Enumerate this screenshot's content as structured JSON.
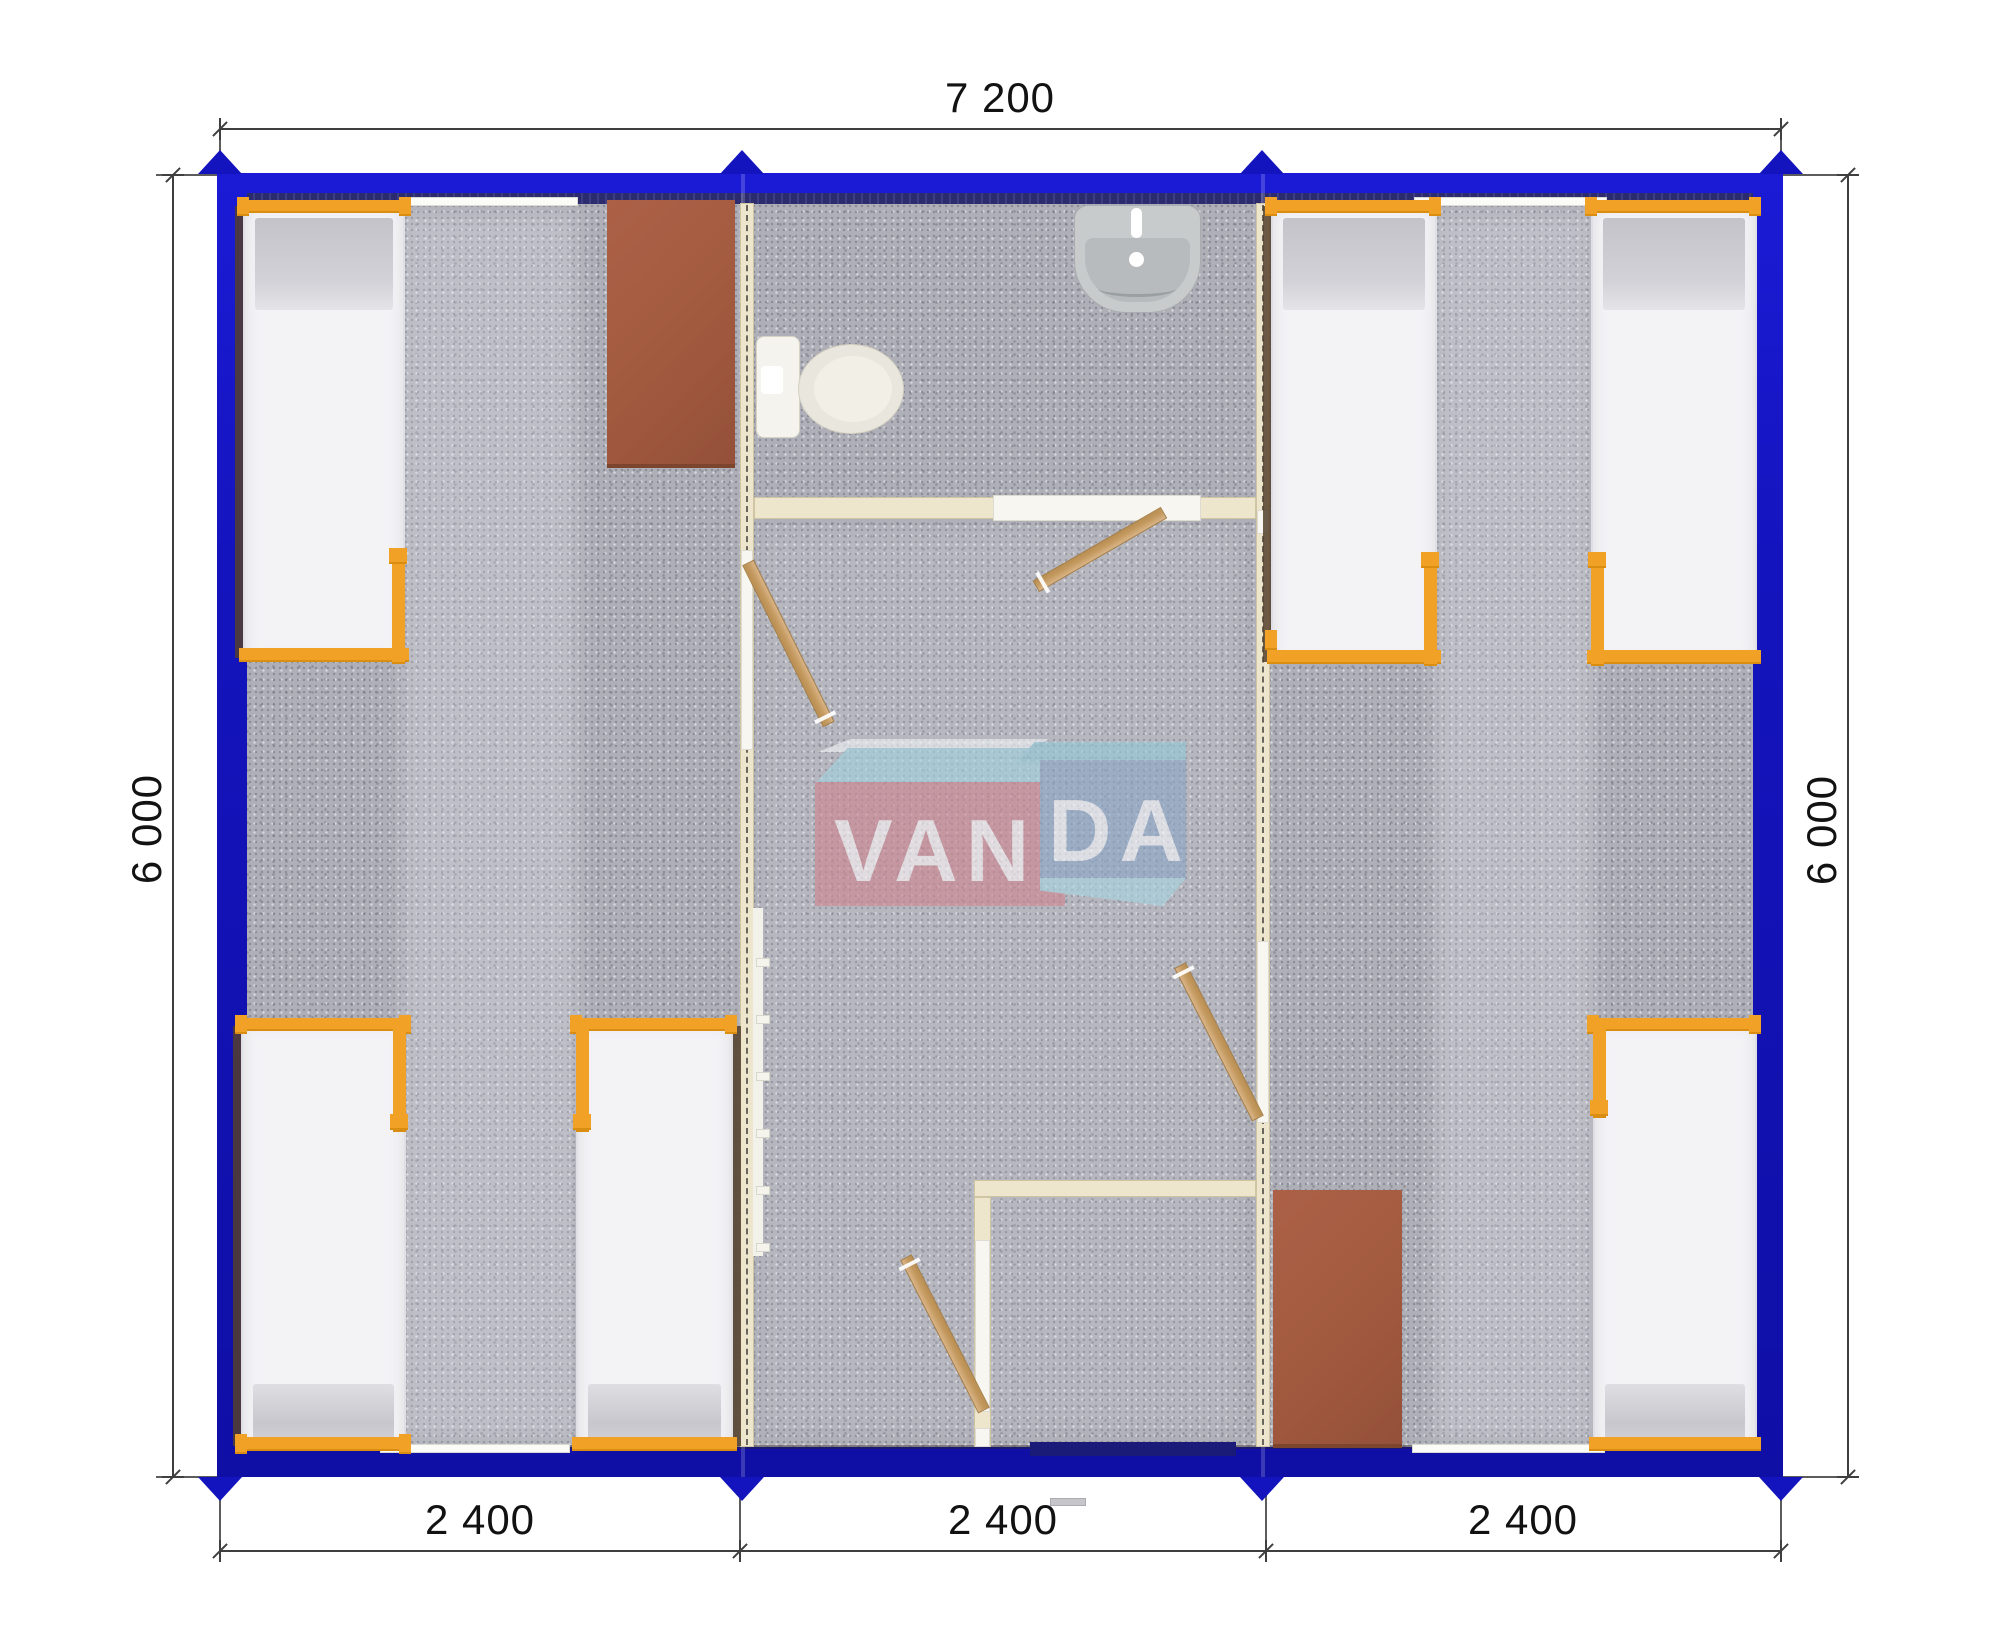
{
  "title": "VANDA modular bunkhouse floor plan",
  "dimensions": {
    "top": {
      "label": "7 200",
      "value_mm": 7200
    },
    "left": {
      "label": "6 000",
      "value_mm": 6000
    },
    "right": {
      "label": "6 000",
      "value_mm": 6000
    },
    "bottom": [
      {
        "label": "2 400",
        "value_mm": 2400
      },
      {
        "label": "2 400",
        "value_mm": 2400
      },
      {
        "label": "2 400",
        "value_mm": 2400
      }
    ]
  },
  "building": {
    "width_mm": 7200,
    "depth_mm": 6000,
    "module_mm": 2400,
    "modules": 3
  },
  "logo": {
    "part1": "VAN",
    "part2": "DA"
  },
  "furniture_counts": {
    "beds": 6,
    "desks": 2,
    "toilets": 1,
    "sinks": 1,
    "interior_doors": 4
  },
  "colors": {
    "wall_blue": "#1414BE",
    "wall_navy": "#2B2B6E",
    "entrance_navy": "#1A1A78",
    "cream": "#EDE6CC",
    "cream_edge": "#CFC5A2",
    "lintel": "#F7F6F0",
    "orange": "#F0A126",
    "orange_dark": "#D98E12",
    "bed_white": "#F3F3F6",
    "bed_edge": "#DFDFE5",
    "pillow": "#C9C9CF",
    "shadow_brown": "#54402C",
    "wood": "#CCA36E",
    "desk_brown": "#A25A3E",
    "carpet": "#AFAFB7",
    "toilet_body": "#EAE8DE",
    "sink_body": "#C8CBCC",
    "logo_red": "#CC8490",
    "logo_blue": "#8AA6C7",
    "logo_cyan": "#9FD2DE",
    "dim": "#3F3F3F",
    "text": "#121212"
  }
}
